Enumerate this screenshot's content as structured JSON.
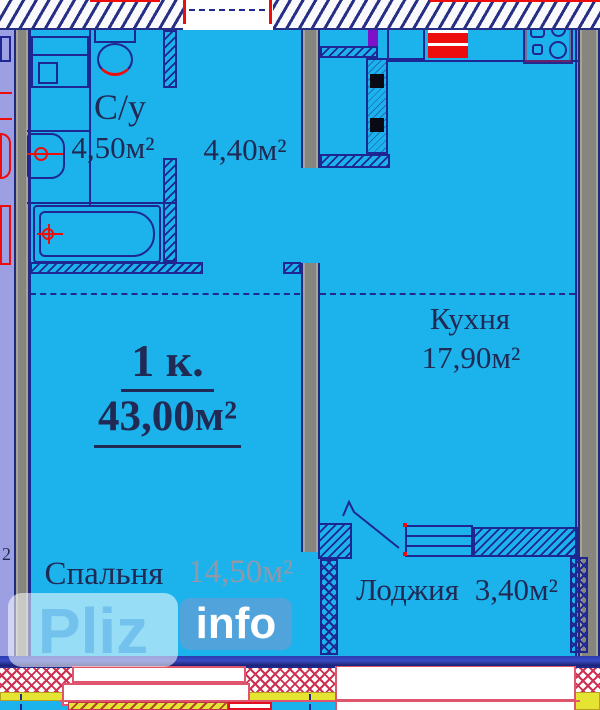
{
  "plan": {
    "type": "apartment-floor-plan",
    "unit": {
      "rooms_label": "1 к.",
      "total_area": "43,00м²"
    },
    "rooms": {
      "bathroom": {
        "name": "С/у",
        "area": "4,50м²"
      },
      "hallway": {
        "area": "4,40м²"
      },
      "kitchen": {
        "name": "Кухня",
        "area": "17,90м²"
      },
      "bedroom": {
        "name": "Спальня",
        "area": "14,50м²"
      },
      "loggia": {
        "name": "Лоджия",
        "area": "3,40м²"
      }
    },
    "neighbor_area_superscript": "2",
    "watermark": {
      "primary": "Pliz",
      "secondary": "info"
    },
    "colors": {
      "floor_cyan": "#1cb3ec",
      "line_navy": "#1e2693",
      "text_navy": "#212a54",
      "wall_gray": "#8e8e86",
      "neighbor_lavender": "#9c9fe2",
      "fixture_red": "#ee0d0d",
      "sill_yellow": "#e6e432",
      "accent_purple": "#7d12c9",
      "window_pink": "#e0556e",
      "watermark_blue": "#70c0ec"
    }
  }
}
